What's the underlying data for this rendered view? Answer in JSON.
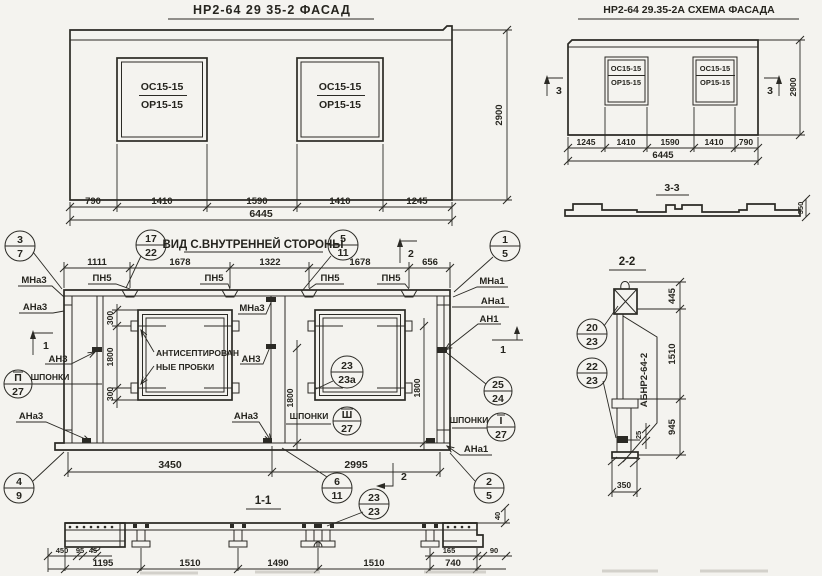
{
  "facade": {
    "title": "НР2-64 29 35-2  ФАСАД",
    "win": {
      "top": "ОС15-15",
      "bot": "ОР15-15"
    },
    "dims": [
      "790",
      "1410",
      "1590",
      "1410",
      "1245"
    ],
    "total": "6445",
    "height": "2900"
  },
  "schema": {
    "title": "НР2-64 29.35-2А  СХЕМА ФАСАДА",
    "win": {
      "top": "ОС15-15",
      "bot": "ОР15-15"
    },
    "marker": "3",
    "dims": [
      "1245",
      "1410",
      "1590",
      "1410",
      "790"
    ],
    "total": "6445",
    "height": "2900",
    "section": {
      "title": "3-3",
      "depth": "350"
    }
  },
  "inner": {
    "title": "ВИД С.ВНУТРЕННЕЙ СТОРОНЫ",
    "top_dims": [
      "1111",
      "1678",
      "1322",
      "1678",
      "656"
    ],
    "bottom_dims": [
      "3450",
      "2995"
    ],
    "loop": "ПН5",
    "note1": "АНТИСЕПТИРОВАН",
    "note2": "НЫЕ ПРОБКИ",
    "keys": "ШПОНКИ",
    "lbl": {
      "mna3": "МНа3",
      "ana3": "АНа3",
      "an3": "АН3",
      "mna1": "МНа1",
      "ana1": "АНа1",
      "an1": "АН1"
    },
    "m1": "1",
    "m2": "2",
    "d300": "300",
    "d1800": "1800",
    "bal": {
      "b37": {
        "t": "3",
        "b": "7"
      },
      "b1722": {
        "t": "17",
        "b": "22"
      },
      "b511": {
        "t": "5",
        "b": "11"
      },
      "b15": {
        "t": "1",
        "b": "5"
      },
      "b2524": {
        "t": "25",
        "b": "24"
      },
      "bII": {
        "t": "П",
        "b": "27"
      },
      "bIII": {
        "t": "Ш",
        "b": "27"
      },
      "bI": {
        "t": "I",
        "b": "27"
      },
      "b23a": {
        "t": "23",
        "b": "23а"
      },
      "b49": {
        "t": "4",
        "b": "9"
      },
      "b611": {
        "t": "6",
        "b": "11"
      },
      "b25": {
        "t": "2",
        "b": "5"
      },
      "b2323": {
        "t": "23",
        "b": "23"
      }
    },
    "section_title": "1-1"
  },
  "s11": {
    "left_dims": [
      "450",
      "95",
      "45"
    ],
    "dims": [
      "1195",
      "1510",
      "1490",
      "1510",
      "740"
    ],
    "right_dims": [
      "165",
      "90"
    ],
    "lip": "40"
  },
  "s22": {
    "title": "2-2",
    "dims": [
      "445",
      "1510",
      "945"
    ],
    "d25": "25",
    "d350": "350",
    "tag": "АБНР2-64-2",
    "bal": {
      "b2023": {
        "t": "20",
        "b": "23"
      },
      "b2223": {
        "t": "22",
        "b": "23"
      }
    }
  }
}
